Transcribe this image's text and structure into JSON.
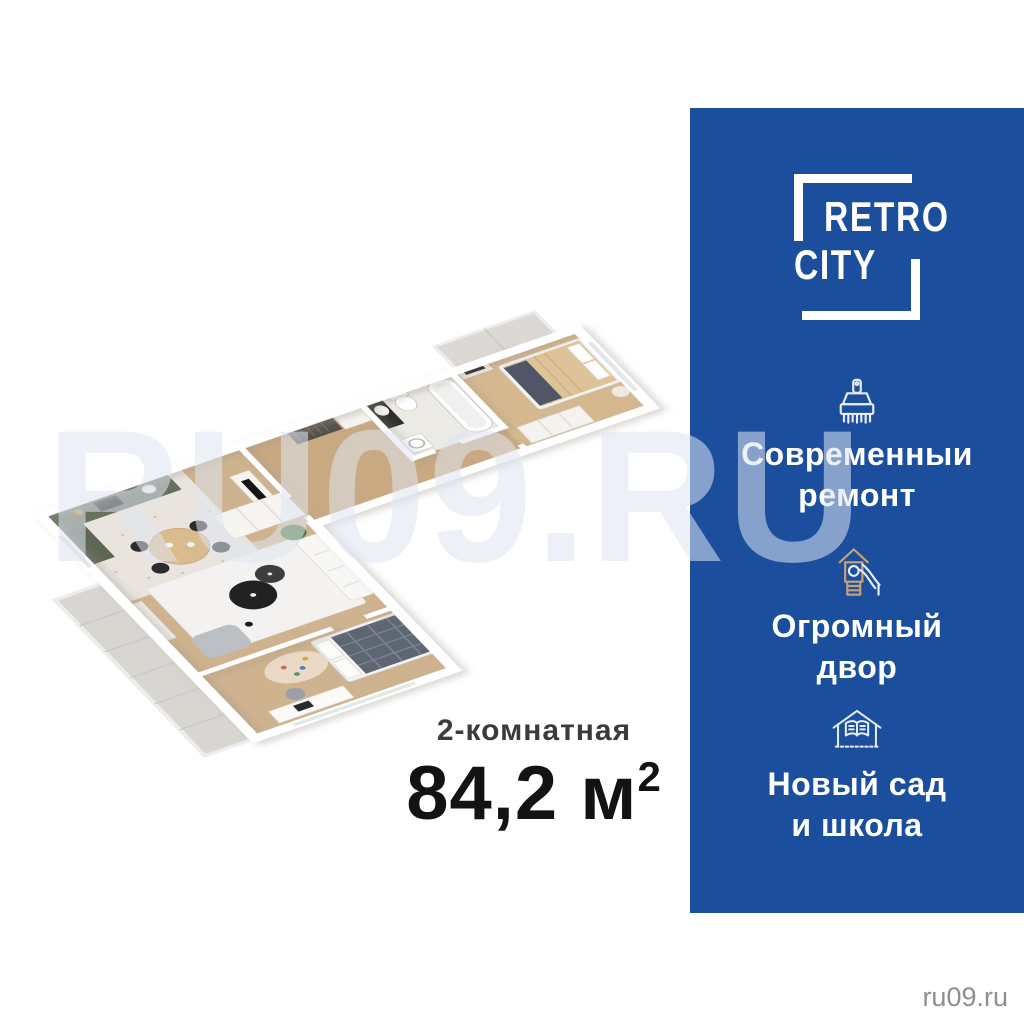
{
  "brand": {
    "line1": "RETRO",
    "line2": "CITY"
  },
  "sidebar": {
    "bg_color": "#1b4f9d",
    "text_color": "#ffffff",
    "features": [
      {
        "icon": "paintbrush-icon",
        "line1": "Современныи",
        "line2": "ремонт"
      },
      {
        "icon": "playground-slide-icon",
        "line1": "Огромный",
        "line2": "двор"
      },
      {
        "icon": "school-icon",
        "line1": "Новый сад",
        "line2": "и школа"
      }
    ]
  },
  "listing": {
    "type_label": "2-комнатная",
    "area_number": "84,2",
    "area_unit": " м",
    "area_superscript": "2"
  },
  "watermark": "RU09.RU",
  "site_credit": "ru09.ru",
  "floorplan": {
    "description": "3D isometric floor plan of a 2-room apartment with kitchen-living room, two bedrooms, bathroom, hallway and glazed balconies",
    "colors": {
      "wood_floor": "#cfb28e",
      "corridor_floor": "#c9a982",
      "terrazzo_floor": "#e9e4de",
      "balcony_floor": "#d9d5d0",
      "kitchen_cabinet": "#66705d",
      "living_rug": "#f3f2f0",
      "bed_blanket": "#4f5766",
      "bedding_tan": "#dec399",
      "walls": "#ffffff"
    }
  }
}
